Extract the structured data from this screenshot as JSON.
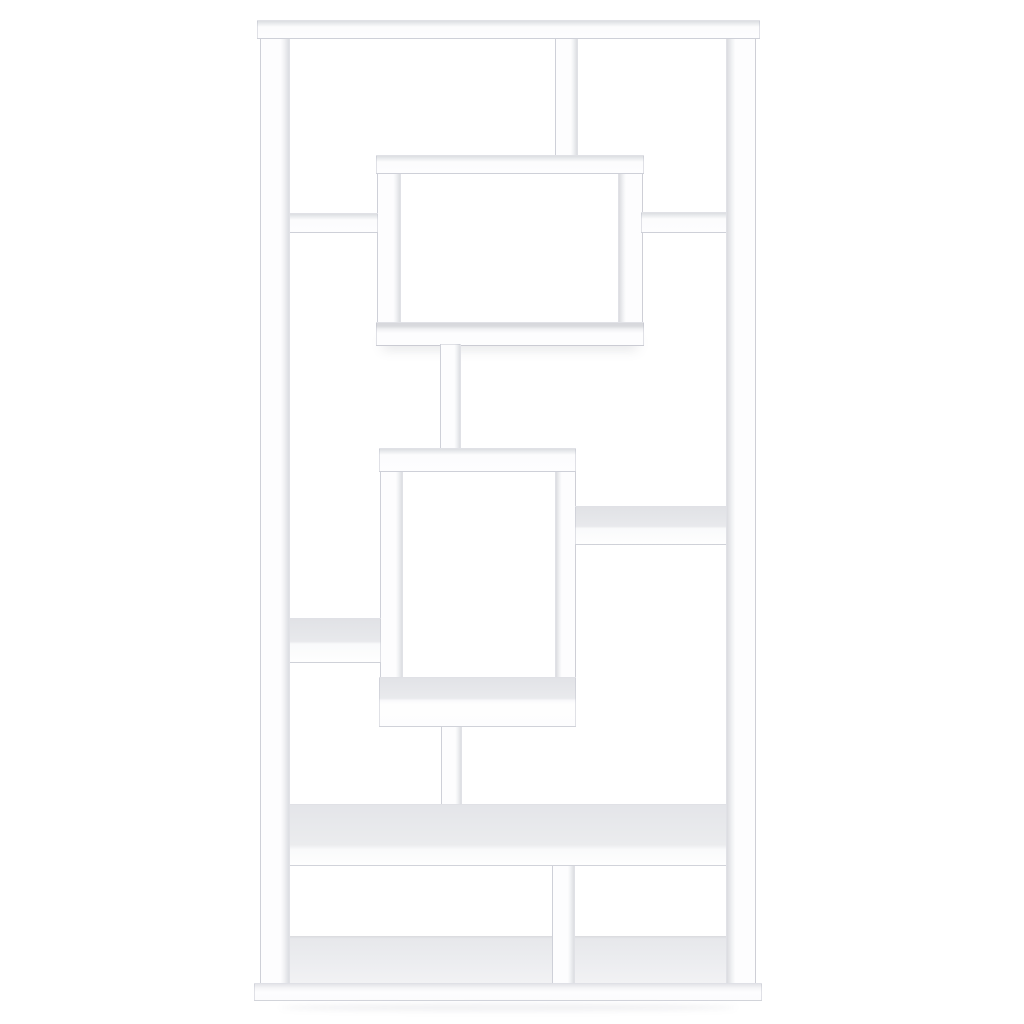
{
  "scene": {
    "description": "Product photo of a white geometric cube bookcase with asymmetric interlocking shelves on a plain white background",
    "background_color": "#ffffff"
  },
  "bookcase": {
    "palette": {
      "face": "#fdfdfe",
      "top_surface": "#e8e9ec",
      "edge_shade": "#dcdee2",
      "outline": "#e3e4e8"
    },
    "members": [
      {
        "name": "bottom-deck-surface",
        "x": 287,
        "y": 936,
        "w": 442,
        "h": 48,
        "style": "deck"
      },
      {
        "name": "upper-box-left-wall",
        "x": 377,
        "y": 156,
        "w": 24,
        "h": 190,
        "style": "shade-r"
      },
      {
        "name": "upper-box-right-wall",
        "x": 618,
        "y": 156,
        "w": 25,
        "h": 190,
        "style": "shade-l"
      },
      {
        "name": "top-divider",
        "x": 555,
        "y": 37,
        "w": 23,
        "h": 122,
        "style": "shade-r"
      },
      {
        "name": "upper-box-top",
        "x": 376,
        "y": 155,
        "w": 268,
        "h": 19,
        "style": "sh-top"
      },
      {
        "name": "upper-left-shelf",
        "x": 288,
        "y": 213,
        "w": 90,
        "h": 20,
        "style": "sh-top"
      },
      {
        "name": "upper-right-shelf",
        "x": 641,
        "y": 212,
        "w": 87,
        "h": 21,
        "style": "sh-top"
      },
      {
        "name": "upper-box-bottom",
        "x": 376,
        "y": 322,
        "w": 268,
        "h": 24,
        "style": "sh-bottom"
      },
      {
        "name": "upper-connector",
        "x": 440,
        "y": 344,
        "w": 21,
        "h": 108,
        "style": "shade-r"
      },
      {
        "name": "center-box-left-wall",
        "x": 380,
        "y": 449,
        "w": 23,
        "h": 278,
        "style": "shade-r"
      },
      {
        "name": "center-box-right-wall",
        "x": 555,
        "y": 449,
        "w": 21,
        "h": 278,
        "style": "shade-l"
      },
      {
        "name": "center-box-top",
        "x": 379,
        "y": 448,
        "w": 197,
        "h": 24,
        "style": "sh-top"
      },
      {
        "name": "middle-right-shelf",
        "x": 575,
        "y": 506,
        "w": 152,
        "h": 39,
        "style": "surf55"
      },
      {
        "name": "middle-left-shelf",
        "x": 288,
        "y": 618,
        "w": 93,
        "h": 45,
        "style": "surf55"
      },
      {
        "name": "lower-connector",
        "x": 441,
        "y": 724,
        "w": 21,
        "h": 96,
        "style": "shade-r"
      },
      {
        "name": "center-box-bottom",
        "x": 379,
        "y": 677,
        "w": 197,
        "h": 50,
        "style": "surf46"
      },
      {
        "name": "bottom-divider",
        "x": 552,
        "y": 856,
        "w": 23,
        "h": 128,
        "style": "shade-r"
      },
      {
        "name": "wide-lower-shelf",
        "x": 288,
        "y": 804,
        "w": 440,
        "h": 62,
        "style": "surf76"
      },
      {
        "name": "left-side-panel",
        "x": 260,
        "y": 37,
        "w": 30,
        "h": 947,
        "style": "shade-r"
      },
      {
        "name": "right-side-panel",
        "x": 726,
        "y": 37,
        "w": 30,
        "h": 947,
        "style": "shade-l"
      },
      {
        "name": "top-panel",
        "x": 257,
        "y": 20,
        "w": 503,
        "h": 19,
        "style": "sh-top"
      },
      {
        "name": "base-plinth",
        "x": 254,
        "y": 983,
        "w": 508,
        "h": 18,
        "style": "base"
      },
      {
        "name": "floor-shadow",
        "x": 280,
        "y": 1004,
        "w": 456,
        "h": 7,
        "style": "shadow"
      }
    ]
  }
}
